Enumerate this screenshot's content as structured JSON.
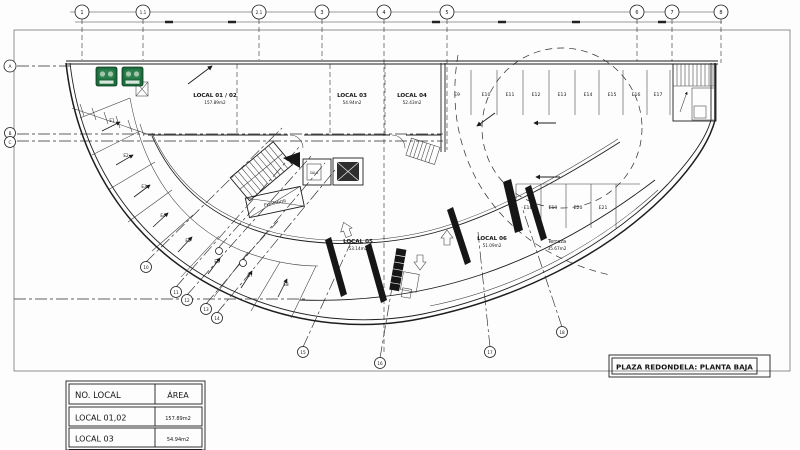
{
  "sheet": {
    "title": "PLAZA REDONDELA: PLANTA BAJA"
  },
  "summary_table": {
    "col_no_local": "NO. LOCAL",
    "col_area": "ÁREA",
    "rows": [
      {
        "name": "LOCAL 01,02",
        "area": "157.89m2"
      },
      {
        "name": "LOCAL 03",
        "area": "54.94m2"
      }
    ]
  },
  "locals": [
    {
      "name": "LOCAL 01 / 02",
      "area": "157.89m2"
    },
    {
      "name": "LOCAL 03",
      "area": "54.94m2"
    },
    {
      "name": "LOCAL 04",
      "area": "52.43m2"
    },
    {
      "name": "LOCAL 05",
      "area": "53.14m2"
    },
    {
      "name": "LOCAL 06",
      "area": "51.09m2"
    },
    {
      "name": "Terraza",
      "area": "35.67m2"
    }
  ],
  "core": {
    "elevator": "ELEVADOR",
    "room": "SALA"
  },
  "parking": {
    "arc": [
      "E1",
      "E2",
      "E3",
      "E4",
      "E5",
      "E6",
      "E7",
      "E8"
    ],
    "top": [
      "E9",
      "E10",
      "E11",
      "E12",
      "E13",
      "E14",
      "E15",
      "E16",
      "E17"
    ],
    "mid": [
      "E18",
      "E19",
      "E20",
      "E21"
    ]
  },
  "grid": {
    "top": [
      "1",
      "1.1",
      "2.1",
      "3",
      "4",
      "5",
      "6",
      "7",
      "8"
    ],
    "left": [
      "A",
      "B",
      "C"
    ],
    "arc_left": [
      "10",
      "11",
      "12",
      "13",
      "14"
    ],
    "arc_bottom": [
      "15",
      "16",
      "17",
      "18"
    ]
  },
  "colors": {
    "line": "#1a1a1a",
    "sign_green": "#1d6c3b",
    "paper": "#fdfdfd"
  }
}
